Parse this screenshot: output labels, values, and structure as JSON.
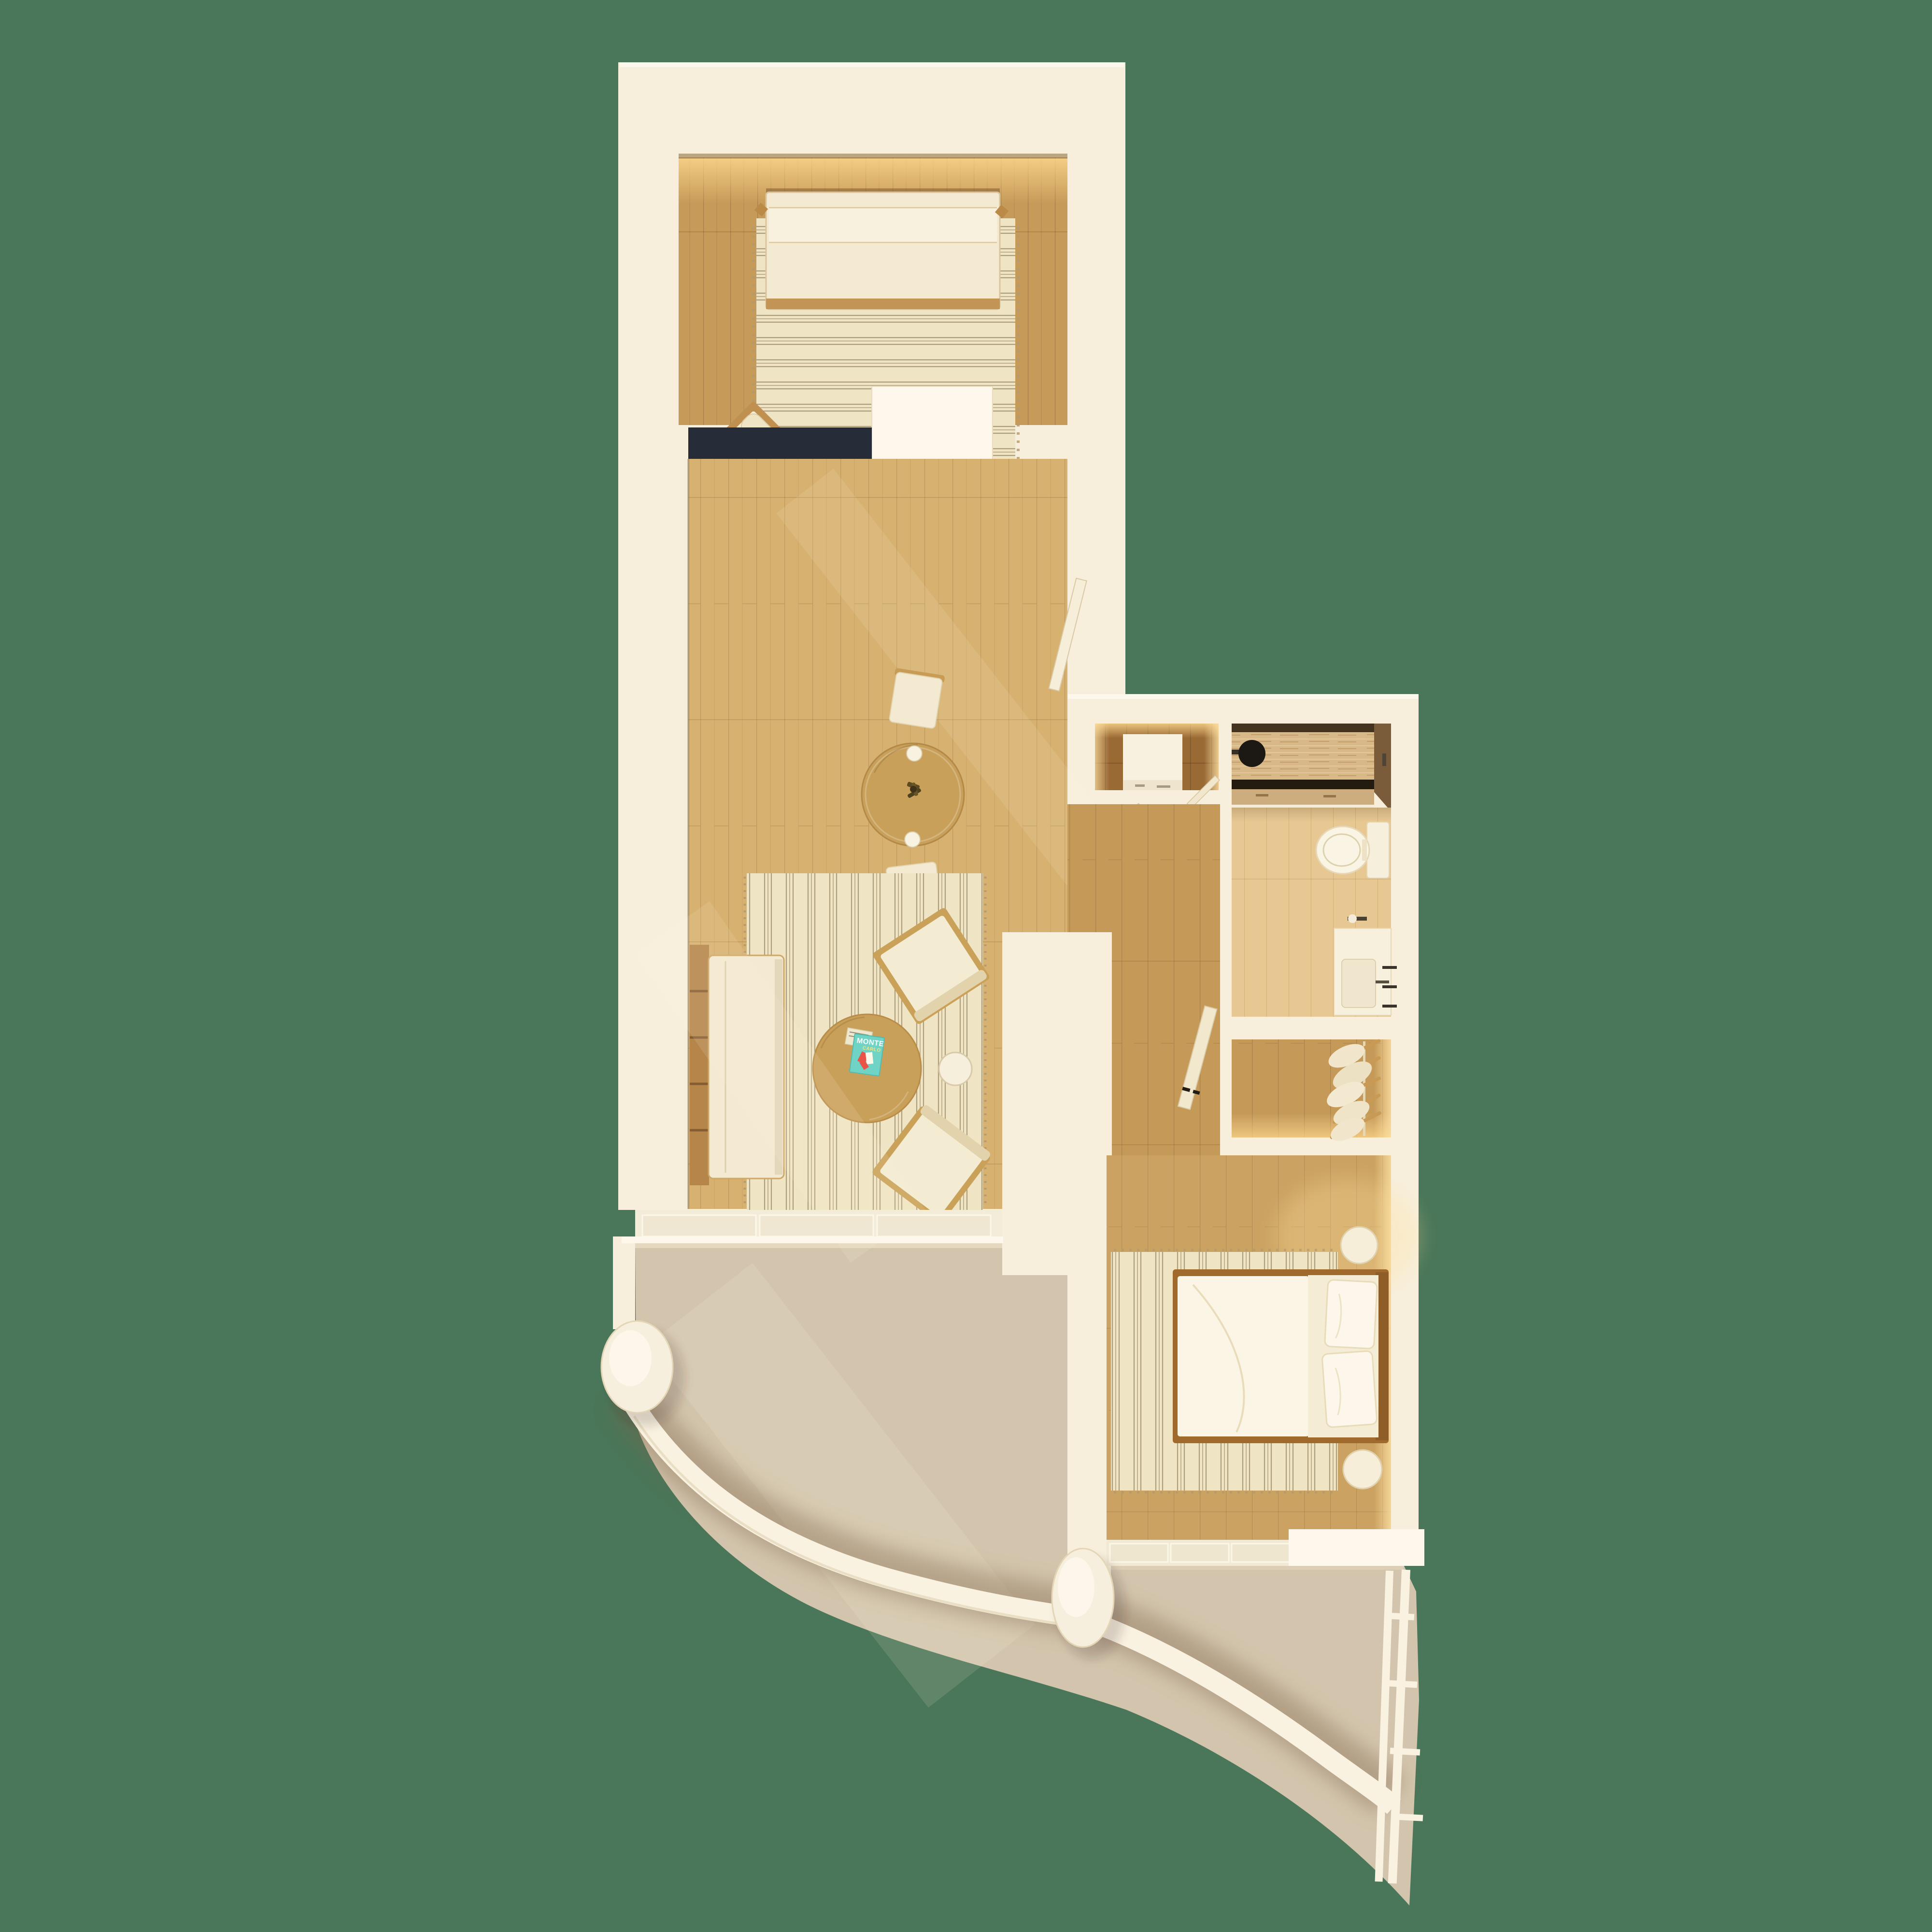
{
  "meta": {
    "title": "Apartment floor plan — top-down 3D render",
    "view": "top-down orthographic",
    "background": "dark sage green"
  },
  "palette": {
    "bg": "#4a7659",
    "wall": "#f7efdc",
    "wallBright": "#fdf8eb",
    "glow": "#ffe3a8",
    "woodTop": "#c69a58",
    "woodMain": "#d7b170",
    "woodMid": "#c59a59",
    "woodNook": "#9a6a35",
    "bathFloor": "#e8c892",
    "travWall": "#d8b886",
    "navy": "#262c38",
    "counter": "#ecdcae",
    "cabinet": "#9e5e26",
    "sinkBrown": "#8f7d57",
    "tableWood": "#c9a05a",
    "rugBase": "#efe4c3",
    "rugStripe": "#a2906e",
    "cream": "#f3ead1",
    "bedding": "#fbf5e5",
    "woodTrim": "#ba8a46",
    "teal": "#6fd3c5",
    "tealTxt": "#ffffff",
    "tealSub": "#f8e37a",
    "terrace": "#d3c5ad",
    "terraceShadow": "#7d6246",
    "railing": "#f9f2e0",
    "frame": "#caa158"
  },
  "magazine": {
    "title": "MONTE",
    "subtitle": "CARLO"
  },
  "rooms": [
    {
      "name": "study",
      "furniture": [
        "daybed",
        "striped rug",
        "lounge chair",
        "round ottoman"
      ]
    },
    {
      "name": "kitchen",
      "furniture": [
        "navy L-counter",
        "speckled worktop",
        "oven",
        "sink",
        "wood cabinet",
        "dishwasher"
      ]
    },
    {
      "name": "dining",
      "furniture": [
        "round wood table",
        "plant centerpiece",
        "2 cups",
        "2 chairs",
        "open entry door"
      ]
    },
    {
      "name": "living",
      "furniture": [
        "sofa",
        "wood slat bench",
        "striped rug",
        "round coffee table",
        "magazines",
        "2 armchairs",
        "white side table"
      ]
    },
    {
      "name": "vestibule",
      "furniture": [
        "white cabinet"
      ]
    },
    {
      "name": "hallway",
      "furniture": [
        "open door to vestibule",
        "open door to bedroom"
      ]
    },
    {
      "name": "bathroom",
      "furniture": [
        "rain shower",
        "travertine wall",
        "storage drawers",
        "toilet",
        "toilet-paper holder",
        "vanity with sink",
        "towel bars"
      ]
    },
    {
      "name": "closet",
      "furniture": [
        "clothes rail",
        "hangers with clothes"
      ]
    },
    {
      "name": "bedroom",
      "furniture": [
        "double bed",
        "duvet",
        "2 pillows",
        "striped rug",
        "2 round nightstands",
        "sliding glass door"
      ]
    },
    {
      "name": "terrace-upper",
      "furniture": [
        "curved railing",
        "round column"
      ]
    },
    {
      "name": "terrace-lower",
      "furniture": [
        "curved railing",
        "round column",
        "rung railing"
      ]
    }
  ]
}
